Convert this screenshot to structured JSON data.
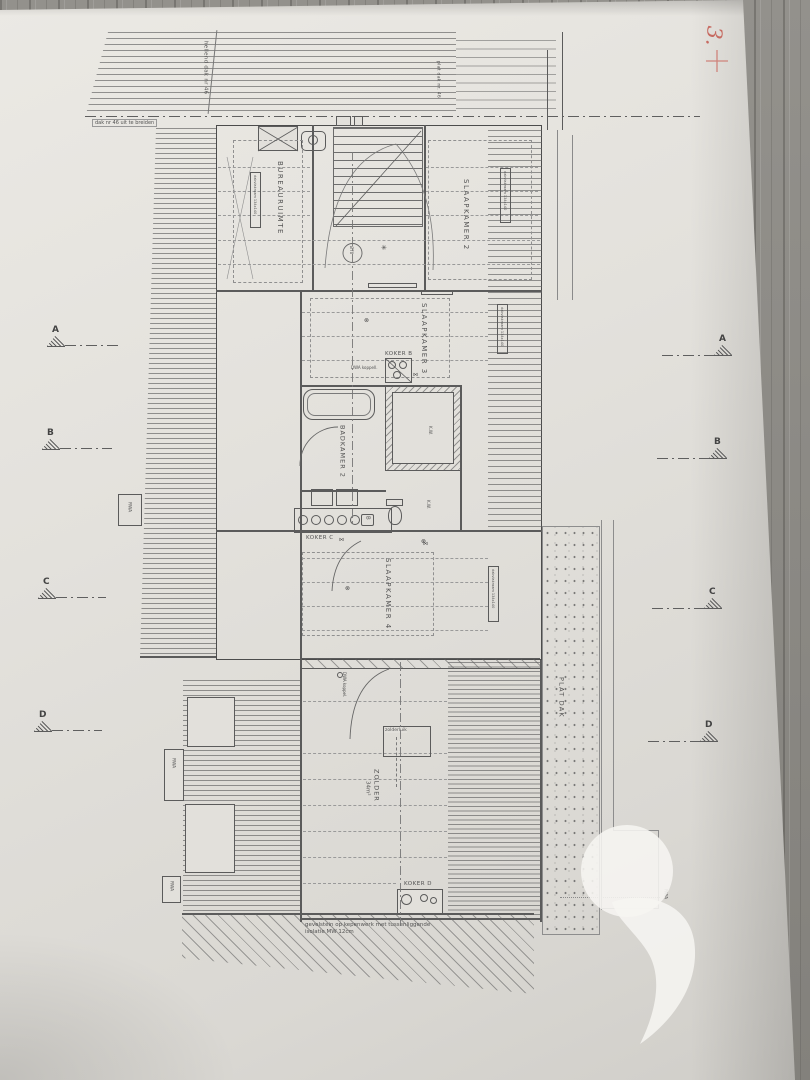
{
  "palette": {
    "paper": "#e3e1dc",
    "wood": "#8e8c87",
    "ink": "#555555",
    "red_annotation": "#c2564c"
  },
  "annotations": {
    "red_number": "3.",
    "red_cross": "+"
  },
  "site": {
    "sloped_roof": "hellend dak nr 46",
    "flat_roof_top": "plat dak nr. 46",
    "boundary_note": "dak nr 46 uit te breiden",
    "flat_roof": "PLAT DAK",
    "facade_note_1": "gevelstein op kepenwerk met tussenliggende",
    "facade_note_2": "isolatie MW 12cm"
  },
  "rooms": {
    "bureau": "BUREAURUIMTE",
    "bedroom2": "SLAAPKAMER 2",
    "bedroom3": "SLAAPKAMER 3",
    "bathroom2": "BADKAMER 2",
    "bedroom4": "SLAAPKAMER 4",
    "attic": "ZOLDER",
    "attic_area": "34m²"
  },
  "shafts": {
    "koker_b": "KOKER B",
    "koker_c": "KOKER C",
    "koker_d": "KOKER D"
  },
  "labels": {
    "dwa_1": "DWA koppell.",
    "dwa_2": "DWA koppel.",
    "kw": "K.W.",
    "rwa": "RWA",
    "diameter": "Ø70",
    "b_mark": "B",
    "zolderluik": "zolderluik",
    "roof_window": "dakvlakraam 134x140"
  },
  "sections": {
    "a": "A",
    "b": "B",
    "c": "C",
    "d": "D"
  }
}
